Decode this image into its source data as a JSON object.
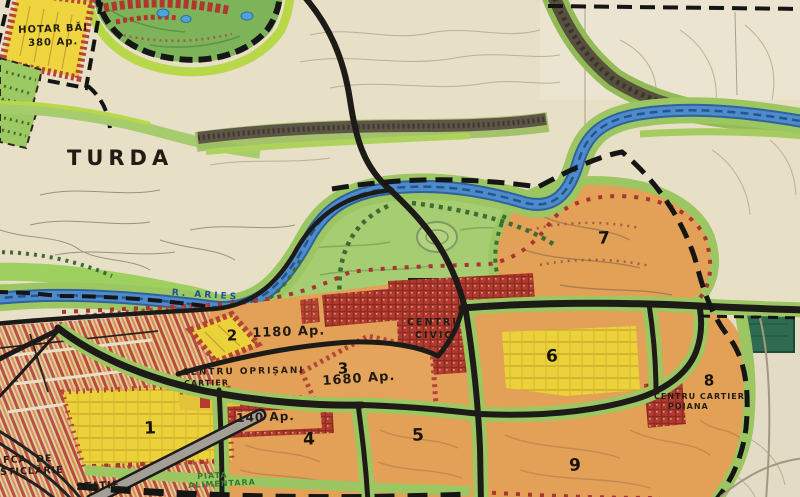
{
  "map": {
    "region_label": "TURDA",
    "river_label": "R. ARIEȘ",
    "hotar": {
      "line1": "HOTAR BĂI",
      "line2": "380 Ap."
    },
    "zones": {
      "z1": {
        "number": "1"
      },
      "z2": {
        "number": "2",
        "apartments": "1180 Ap."
      },
      "z3": {
        "number": "3",
        "apartments": "1680 Ap."
      },
      "z4": {
        "number": "4",
        "apartments": "140 Ap."
      },
      "z5": {
        "number": "5"
      },
      "z6": {
        "number": "6"
      },
      "z7": {
        "number": "7"
      },
      "z8": {
        "number": "8"
      },
      "z9": {
        "number": "9"
      }
    },
    "centers": {
      "civic": {
        "line1": "CENTRU",
        "line2": "CIVIC"
      },
      "oprisani": {
        "line1": "CENTRU OPRIȘANI",
        "line2": "CARTIER"
      },
      "poiana": {
        "line1": "CENTRU CARTIER",
        "line2": "POIANA"
      }
    },
    "places": {
      "glass_factory": {
        "line1": "FCA. DE",
        "line2": "STICLĂRIE"
      },
      "station": "STATIE",
      "food_market": {
        "line1": "PIATA",
        "line2": "ALIMENTARA"
      }
    },
    "colors": {
      "paper": "#e7dfc6",
      "park_green": "#a6cd72",
      "bright_green": "#b8d84a",
      "river_blue": "#3b7ec2",
      "zone_orange": "#e2a157",
      "zone_yellow": "#ecd23a",
      "red_hatch": "#b23a2e",
      "road_black": "#1c1c1c",
      "dark_green_square": "#2e6b50"
    }
  }
}
